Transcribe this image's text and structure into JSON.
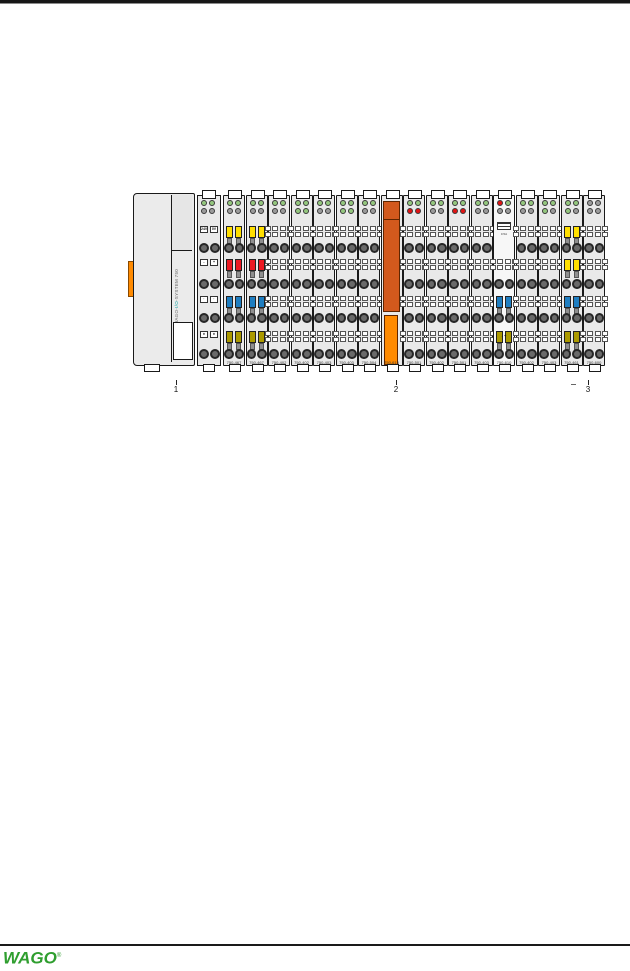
{
  "footer": {
    "logo": "WAGO",
    "trademark": "®",
    "logo_color": "#2f9e2f"
  },
  "figure": {
    "title": "wago-io-node-assembly",
    "callouts": [
      "1",
      "2",
      "3"
    ],
    "coupler": {
      "side_label_prefix": "WAGO-",
      "side_label_mid": "I/O",
      "side_label_suffix": "-SYSTEM 750",
      "accent_color": "#009a9a"
    },
    "power_section": {
      "rows": [
        [
          "24V",
          "0V"
        ],
        [
          "-",
          "+"
        ],
        [
          "·",
          "·"
        ],
        [
          "±",
          "±"
        ]
      ]
    },
    "modules": [
      {
        "label": "750-467",
        "kind": "io",
        "leds": [
          "green",
          "green",
          "gray",
          "gray"
        ],
        "terminals": [
          "yellow",
          "red",
          "blue",
          "olive"
        ]
      },
      {
        "label": "750-467",
        "kind": "io",
        "leds": [
          "green",
          "green",
          "gray",
          "gray"
        ],
        "terminals": [
          "yellow",
          "red",
          "blue",
          "olive"
        ]
      },
      {
        "label": "750-402",
        "kind": "io",
        "leds": [
          "green",
          "green",
          "gray",
          "gray"
        ],
        "terminals": [
          "plain",
          "plain",
          "plain",
          "plain"
        ]
      },
      {
        "label": "750-402",
        "kind": "io",
        "leds": [
          "green",
          "green",
          "green",
          "green"
        ],
        "terminals": [
          "plain",
          "plain",
          "plain",
          "plain"
        ]
      },
      {
        "label": "750-403",
        "kind": "io",
        "leds": [
          "green",
          "green",
          "gray",
          "gray"
        ],
        "terminals": [
          "plain",
          "plain",
          "plain",
          "plain"
        ]
      },
      {
        "label": "750-403",
        "kind": "io",
        "leds": [
          "green",
          "green",
          "green",
          "green"
        ],
        "terminals": [
          "plain",
          "plain",
          "plain",
          "plain"
        ]
      },
      {
        "label": "750-504",
        "kind": "io",
        "leds": [
          "green",
          "green",
          "gray",
          "gray"
        ],
        "terminals": [
          "plain",
          "plain",
          "plain",
          "plain"
        ]
      },
      {
        "label": "750-613",
        "kind": "supply",
        "leds": [],
        "terminals": []
      },
      {
        "label": "750-501",
        "kind": "io",
        "leds": [
          "green",
          "green",
          "red",
          "red"
        ],
        "terminals": [
          "plain",
          "plain",
          "plain",
          "plain"
        ]
      },
      {
        "label": "750-402",
        "kind": "io",
        "leds": [
          "green",
          "green",
          "gray",
          "gray"
        ],
        "terminals": [
          "plain",
          "plain",
          "plain",
          "plain"
        ]
      },
      {
        "label": "750-501",
        "kind": "io",
        "leds": [
          "green",
          "green",
          "red",
          "red"
        ],
        "terminals": [
          "plain",
          "plain",
          "plain",
          "plain"
        ]
      },
      {
        "label": "750-403",
        "kind": "io",
        "leds": [
          "green",
          "green",
          "gray",
          "gray"
        ],
        "terminals": [
          "plain",
          "plain",
          "plain",
          "plain"
        ]
      },
      {
        "label": "750-610",
        "kind": "fuse",
        "leds": [
          "red",
          "green",
          "gray",
          "gray"
        ],
        "terminals": [
          "plain",
          "plain",
          "blue",
          "olive"
        ],
        "fuse_text": "0.5A",
        "marks": "- +"
      },
      {
        "label": "750-402",
        "kind": "io",
        "leds": [
          "green",
          "green",
          "gray",
          "gray"
        ],
        "terminals": [
          "plain",
          "plain",
          "plain",
          "plain"
        ]
      },
      {
        "label": "750-403",
        "kind": "io",
        "leds": [
          "green",
          "green",
          "green",
          "gray"
        ],
        "terminals": [
          "plain",
          "plain",
          "plain",
          "plain"
        ]
      },
      {
        "label": "750-461",
        "kind": "io",
        "leds": [
          "green",
          "green",
          "green",
          "gray"
        ],
        "terminals": [
          "yellow",
          "yellow",
          "blue",
          "olive"
        ]
      },
      {
        "label": "750-600",
        "kind": "end",
        "leds": [
          "gray",
          "gray",
          "gray",
          "gray"
        ],
        "terminals": [
          "plain",
          "plain",
          "plain",
          "plain"
        ]
      }
    ],
    "colors": {
      "body": "#e9e9e9",
      "ledGreen": "#94c77e",
      "ledGray": "#9b9b9b",
      "ledRed": "#e01313",
      "yellow": "#ffdf00",
      "red": "#ec1a23",
      "blue": "#1f7ec1",
      "olive": "#ac9a00",
      "orangeDark": "#d2591d",
      "orangeBright": "#ff8a00",
      "stripe": "#ff8a00"
    }
  }
}
